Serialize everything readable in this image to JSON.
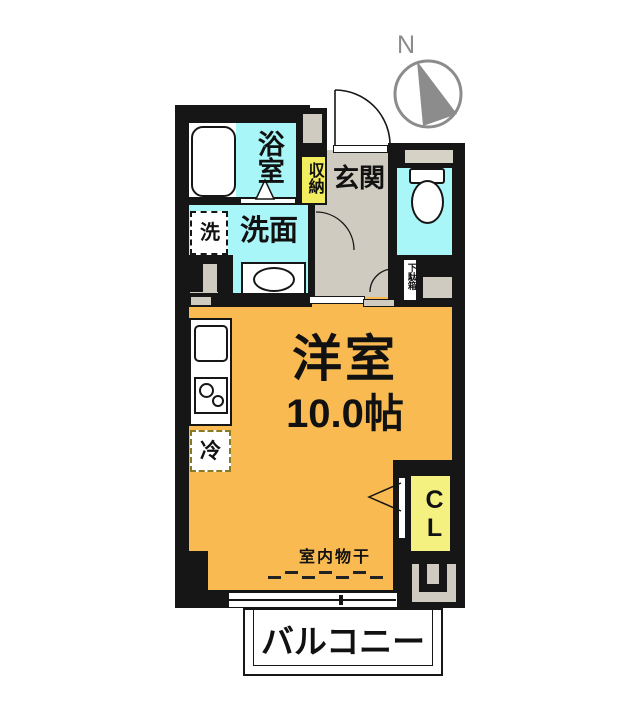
{
  "title": "apartment-floor-plan",
  "compass": {
    "label": "N"
  },
  "rooms": {
    "bath": {
      "label": "浴室"
    },
    "washroom": {
      "label": "洗面"
    },
    "washer": {
      "label": "洗"
    },
    "storage": {
      "label": "収納"
    },
    "entrance": {
      "label": "玄関"
    },
    "shoe_cabinet": {
      "label": "下駄箱"
    },
    "main_room": {
      "name": "洋室",
      "size": "10.0帖"
    },
    "refrigerator": {
      "label": "冷"
    },
    "closet": {
      "label": "CL"
    },
    "indoor_drying": {
      "label": "室内物干"
    },
    "balcony": {
      "label": "バルコニー"
    }
  },
  "colors": {
    "wall": "#161616",
    "wet_area_cyan": "#A9F6F8",
    "hall_gray": "#CFCBC0",
    "room_orange": "#F8BA51",
    "storage_yellow": "#F2EC5F",
    "closet_yellow": "#F5F180",
    "compass_gray": "#8C8C8C",
    "text": "#111111"
  }
}
